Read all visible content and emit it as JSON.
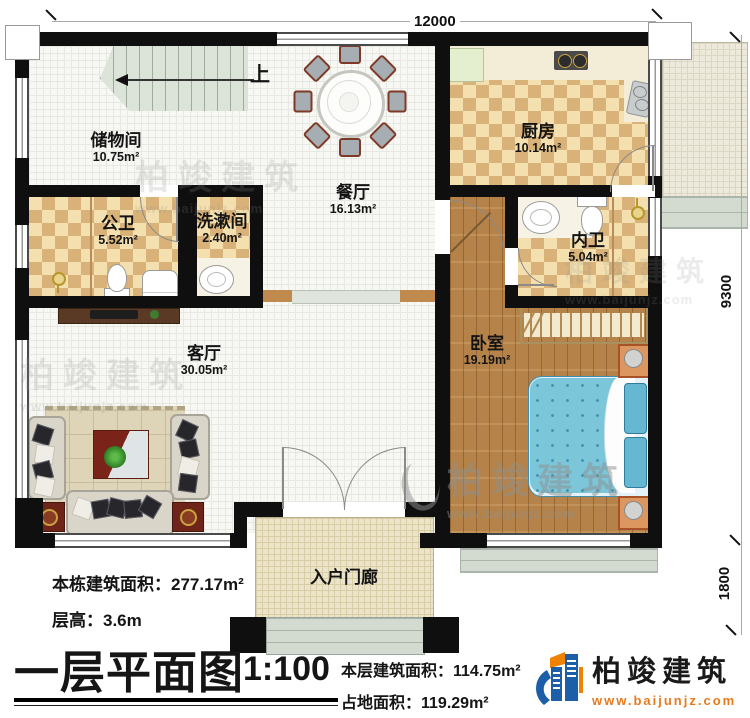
{
  "plan": {
    "stairs_up_label": "上",
    "rooms": {
      "storage": {
        "name": "储物间",
        "area": "10.75m²"
      },
      "public_bath": {
        "name": "公卫",
        "area": "5.52m²"
      },
      "washroom": {
        "name": "洗漱间",
        "area": "2.40m²"
      },
      "dining": {
        "name": "餐厅",
        "area": "16.13m²"
      },
      "kitchen": {
        "name": "厨房",
        "area": "10.14m²"
      },
      "inner_bath": {
        "name": "内卫",
        "area": "5.04m²"
      },
      "bedroom": {
        "name": "卧室",
        "area": "19.19m²"
      },
      "living": {
        "name": "客厅",
        "area": "30.05m²"
      },
      "porch": {
        "name": "入户门廊"
      }
    },
    "dimensions": {
      "top_width": "12000",
      "right_height": "9300",
      "porch_depth": "1800"
    }
  },
  "footer": {
    "building_area_label": "本栋建筑面积：",
    "building_area_value": "277.17m²",
    "floor_height_label": "层高：",
    "floor_height_value": "3.6m",
    "title": "一层平面图",
    "scale": "1:100",
    "floor_area_label": "本层建筑面积：",
    "floor_area_value": "114.75m²",
    "footprint_label": "占地面积：",
    "footprint_value": "119.29m²"
  },
  "branding": {
    "name": "柏竣建筑",
    "website": "www.baijunjz.com"
  },
  "watermark": {
    "name": "柏竣建筑",
    "website": "www.baijunjz.com"
  },
  "colors": {
    "wall": "#0f0f0f",
    "logo_blue": "#1c5fa8",
    "logo_orange": "#ef8200",
    "bed_blue": "#7cc6da"
  }
}
